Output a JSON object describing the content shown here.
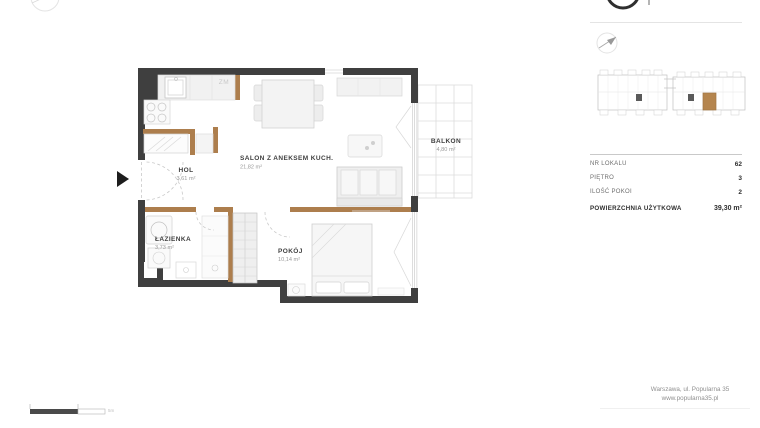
{
  "plan": {
    "rooms": [
      {
        "name": "HOL",
        "area": "3,61 m²"
      },
      {
        "name": "SALON Z ANEKSEM KUCH.",
        "area": "21,82 m²"
      },
      {
        "name": "ŁAZIENKA",
        "area": "3,73 m²"
      },
      {
        "name": "POKÓJ",
        "area": "10,14 m²"
      },
      {
        "name": "BALKON",
        "area": "4,80 m²"
      }
    ],
    "annotations": {
      "kitchen_appliance": "ZM"
    },
    "scale_label": "5m"
  },
  "panel": {
    "rows": [
      {
        "label": "NR LOKALU",
        "value": "62"
      },
      {
        "label": "PIĘTRO",
        "value": "3"
      },
      {
        "label": "ILOŚĆ POKOI",
        "value": "2"
      },
      {
        "label": "POWIERZCHNIA UŻYTKOWA",
        "value": "39,30 m²"
      }
    ],
    "address_line1": "Warszawa, ul. Popularna 35",
    "address_line2": "www.popularna35.pl"
  },
  "colors": {
    "wall": "#3f3f3f",
    "partition": "#ad7e4d",
    "highlight": "#b5854e"
  }
}
